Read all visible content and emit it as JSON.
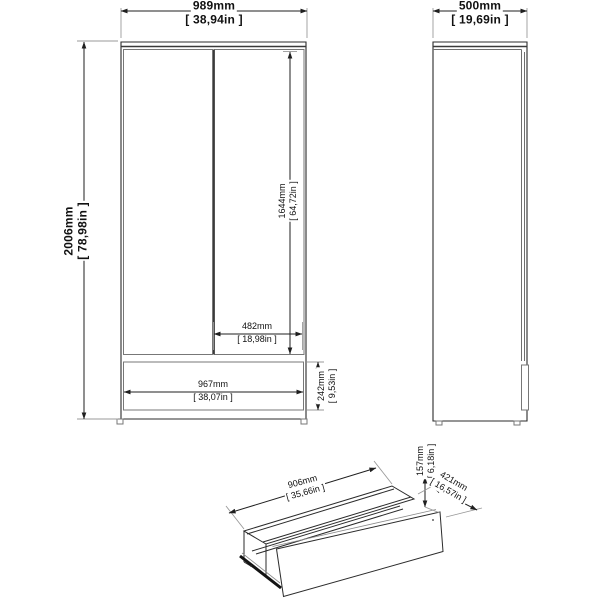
{
  "diagram": {
    "title": "Wardrobe dimension drawing",
    "front_view": {
      "width_mm": "989mm",
      "width_in": "[ 38,94in ]",
      "height_mm": "2006mm",
      "height_in": "[ 78,98in ]",
      "door_height_mm": "1644mm",
      "door_height_in": "[ 64,72in ]",
      "door_width_mm": "482mm",
      "door_width_in": "[ 18,98in ]",
      "drawer_width_mm": "967mm",
      "drawer_width_in": "[ 38,07in ]",
      "drawer_section_height_mm": "242mm",
      "drawer_section_height_in": "[ 9,53in ]"
    },
    "side_view": {
      "depth_mm": "500mm",
      "depth_in": "[ 19,69in ]"
    },
    "drawer_view": {
      "width_mm": "906mm",
      "width_in": "[ 35,66in ]",
      "height_mm": "157mm",
      "height_in": "[ 6,18in ]",
      "depth_mm": "421mm",
      "depth_in": "[ 16,57in ]"
    },
    "colors": {
      "line": "#1f1f1f",
      "light_line": "#9a9a9a",
      "background": "#ffffff"
    }
  }
}
